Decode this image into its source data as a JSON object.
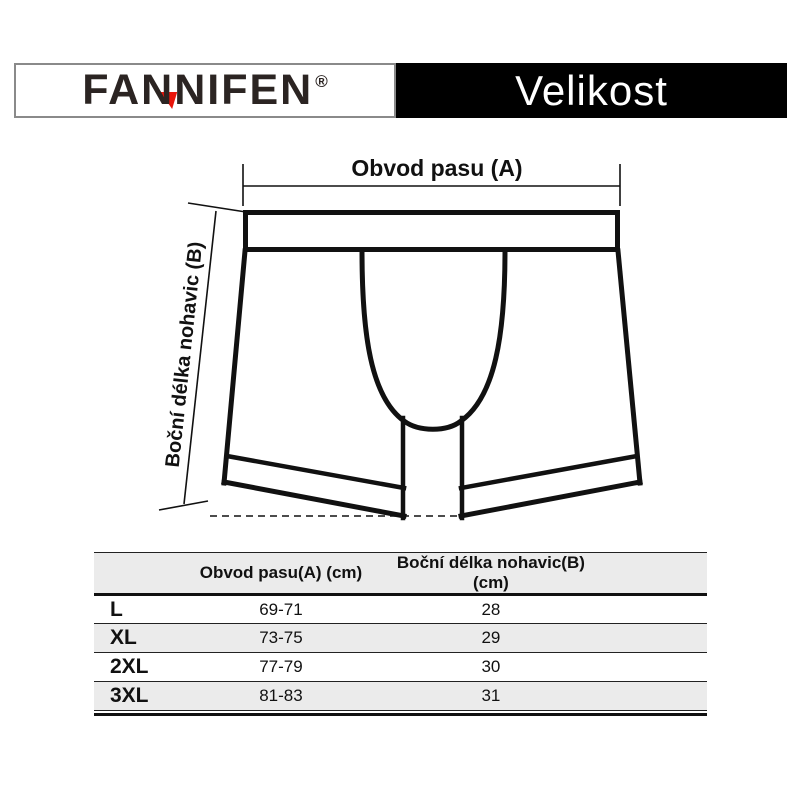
{
  "header": {
    "brand": "FANNIFEN",
    "registered": "®",
    "title": "Velikost"
  },
  "diagram": {
    "waist_label": "Obvod pasu (A)",
    "side_length_label": "Boční délka nohavic (B)"
  },
  "table": {
    "columns": [
      "",
      "Obvod pasu(A) (cm)",
      "Boční délka nohavic(B) (cm)"
    ],
    "rows": [
      {
        "size": "L",
        "waist": "69-71",
        "side_length": "28"
      },
      {
        "size": "XL",
        "waist": "73-75",
        "side_length": "29"
      },
      {
        "size": "2XL",
        "waist": "77-79",
        "side_length": "30"
      },
      {
        "size": "3XL",
        "waist": "81-83",
        "side_length": "31"
      }
    ]
  },
  "colors": {
    "logo_accent_red": "#e8150b",
    "title_bg": "#000000",
    "row_alt_bg": "#ebebeb",
    "line_color": "#111111"
  }
}
